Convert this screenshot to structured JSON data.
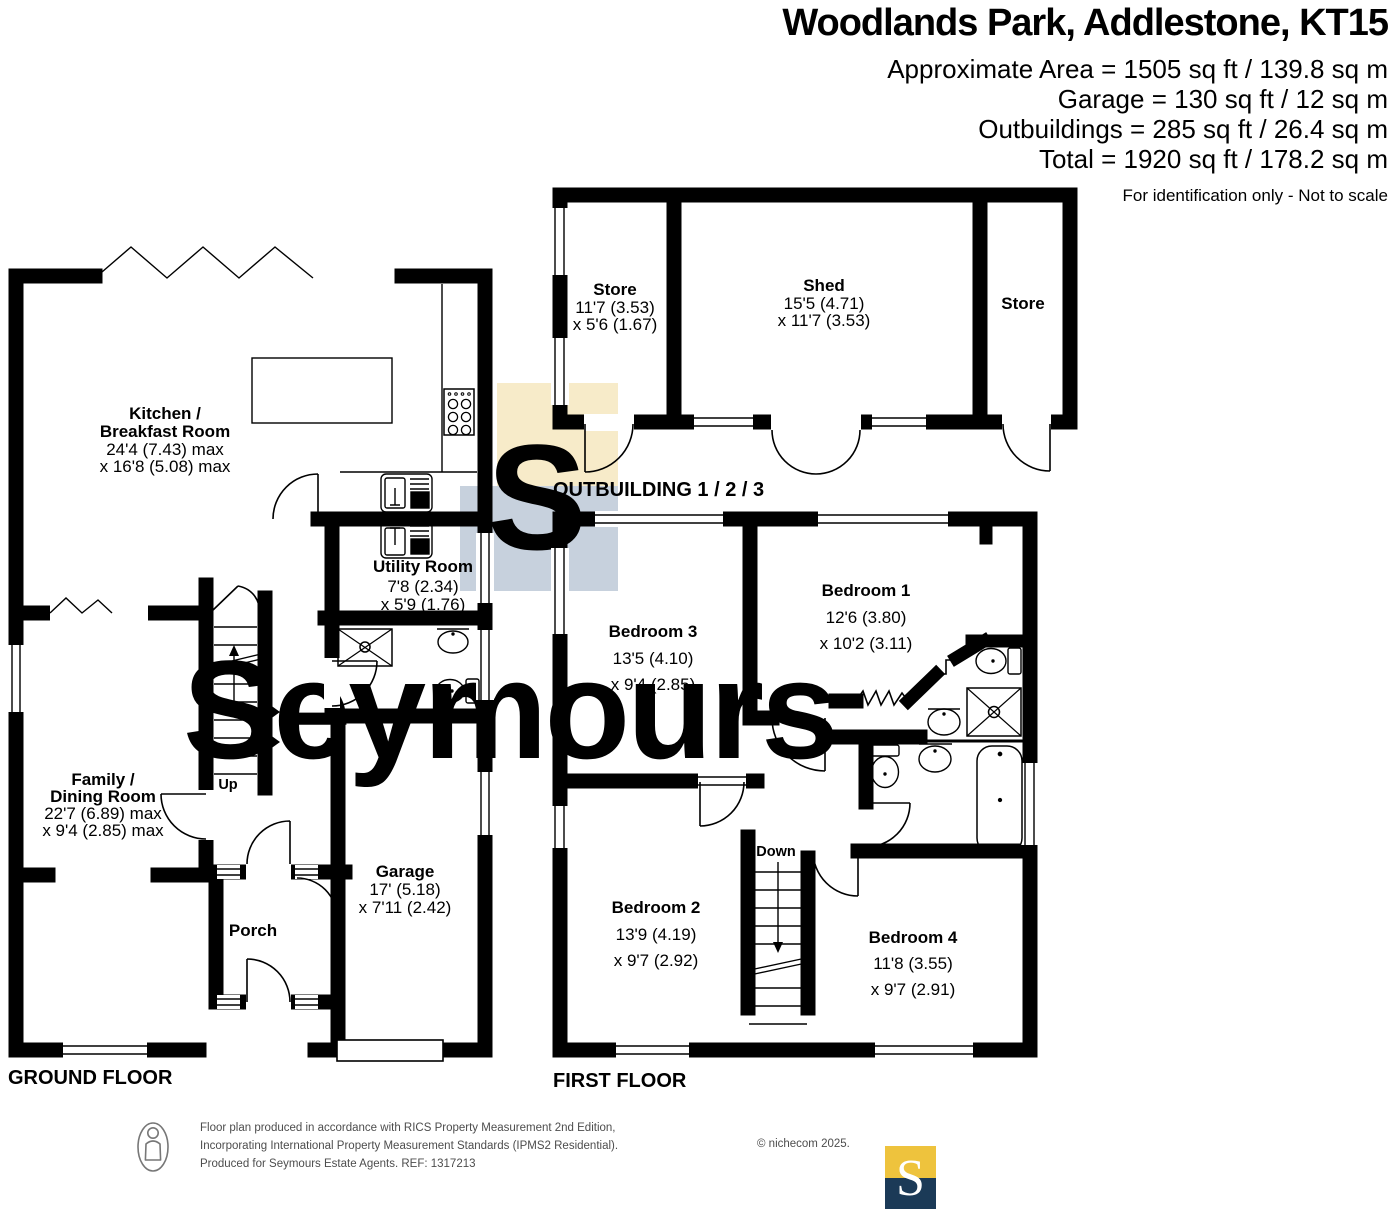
{
  "header": {
    "title": "Woodlands Park, Addlestone, KT15",
    "lines": [
      "Approximate Area = 1505 sq ft / 139.8 sq m",
      "Garage = 130 sq ft / 12 sq m",
      "Outbuildings = 285 sq ft / 26.4 sq m",
      "Total = 1920 sq ft / 178.2 sq m"
    ],
    "note": "For identification only - Not to scale"
  },
  "floors": {
    "ground": "GROUND FLOOR",
    "first": "FIRST FLOOR",
    "outbuilding": "OUTBUILDING 1 / 2 / 3"
  },
  "rooms": {
    "kitchen": {
      "name_line1": "Kitchen /",
      "name_line2": "Breakfast Room",
      "dim1": "24'4 (7.43) max",
      "dim2": "x 16'8 (5.08) max"
    },
    "utility": {
      "name": "Utility Room",
      "dim1": "7'8 (2.34)",
      "dim2": "x 5'9 (1.76)"
    },
    "family": {
      "name_line1": "Family /",
      "name_line2": "Dining Room",
      "dim1": "22'7 (6.89) max",
      "dim2": "x 9'4 (2.85) max"
    },
    "porch": {
      "name": "Porch"
    },
    "garage": {
      "name": "Garage",
      "dim1": "17' (5.18)",
      "dim2": "x 7'11 (2.42)"
    },
    "store1": {
      "name": "Store",
      "dim1": "11'7 (3.53)",
      "dim2": "x 5'6 (1.67)"
    },
    "shed": {
      "name": "Shed",
      "dim1": "15'5 (4.71)",
      "dim2": "x 11'7 (3.53)"
    },
    "store2": {
      "name": "Store"
    },
    "bedroom1": {
      "name": "Bedroom 1",
      "dim1": "12'6 (3.80)",
      "dim2": "x 10'2 (3.11)"
    },
    "bedroom2": {
      "name": "Bedroom 2",
      "dim1": "13'9 (4.19)",
      "dim2": "x 9'7 (2.92)"
    },
    "bedroom3": {
      "name": "Bedroom 3",
      "dim1": "13'5 (4.10)",
      "dim2": "x 9'4 (2.85)"
    },
    "bedroom4": {
      "name": "Bedroom 4",
      "dim1": "11'8 (3.55)",
      "dim2": "x 9'7 (2.91)"
    }
  },
  "stairs": {
    "up": "Up",
    "down": "Down"
  },
  "watermark": {
    "text": "Seymours",
    "monogram": "S"
  },
  "footer": {
    "line1": "Floor plan produced in accordance with RICS Property Measurement 2nd Edition,",
    "line2": "Incorporating International Property Measurement Standards (IPMS2 Residential).",
    "copyright": "© nichecom 2025.",
    "line3": "Produced for Seymours Estate Agents.   REF: 1317213",
    "logo_letter": "S"
  },
  "colors": {
    "wall": "#000000",
    "watermark_blue": "#c7d1dd",
    "watermark_yellow": "#f7ebc9",
    "logo_yellow": "#eec33d",
    "logo_navy": "#1b3a57",
    "footer_gray": "#4d4d4d"
  }
}
